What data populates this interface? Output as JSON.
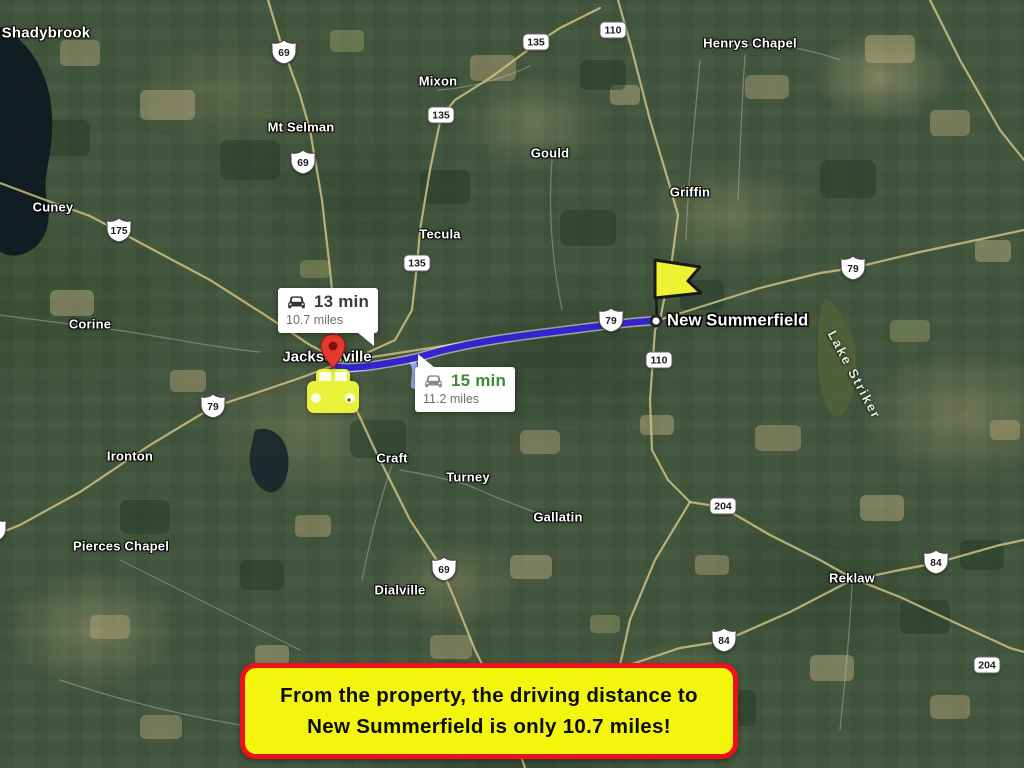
{
  "banner": {
    "line1": "From the property, the driving distance to",
    "line2": "New Summerfield is only 10.7 miles!"
  },
  "route": {
    "origin": "Jacksonville",
    "destination": "New Summerfield",
    "primary": {
      "duration": "13 min",
      "distance": "10.7 miles"
    },
    "alternate": {
      "duration": "15 min",
      "distance": "11.2 miles"
    }
  },
  "map": {
    "lake_label": "Lake Striker",
    "towns": [
      {
        "name": "Shadybrook",
        "x": 46,
        "y": 33,
        "size": "lg"
      },
      {
        "name": "Mixon",
        "x": 438,
        "y": 81
      },
      {
        "name": "Henrys Chapel",
        "x": 750,
        "y": 43
      },
      {
        "name": "Mt Selman",
        "x": 301,
        "y": 127
      },
      {
        "name": "Gould",
        "x": 550,
        "y": 153
      },
      {
        "name": "Griffin",
        "x": 690,
        "y": 192
      },
      {
        "name": "Cuney",
        "x": 53,
        "y": 207
      },
      {
        "name": "Tecula",
        "x": 440,
        "y": 234
      },
      {
        "name": "Corine",
        "x": 90,
        "y": 324
      },
      {
        "name": "Ironton",
        "x": 130,
        "y": 456
      },
      {
        "name": "Craft",
        "x": 392,
        "y": 458
      },
      {
        "name": "Turney",
        "x": 468,
        "y": 477
      },
      {
        "name": "Gallatin",
        "x": 558,
        "y": 517
      },
      {
        "name": "Pierces Chapel",
        "x": 121,
        "y": 546
      },
      {
        "name": "Dialville",
        "x": 400,
        "y": 590
      },
      {
        "name": "Reklaw",
        "x": 852,
        "y": 578
      }
    ],
    "us_shields": [
      {
        "num": "69",
        "x": 284,
        "y": 52
      },
      {
        "num": "69",
        "x": 303,
        "y": 162
      },
      {
        "num": "175",
        "x": 119,
        "y": 230
      },
      {
        "num": "79",
        "x": 213,
        "y": 406
      },
      {
        "num": "79",
        "x": 611,
        "y": 320,
        "under": true
      },
      {
        "num": "79",
        "x": 853,
        "y": 268
      },
      {
        "num": "79",
        "x": -6,
        "y": 530
      },
      {
        "num": "69",
        "x": 444,
        "y": 569
      },
      {
        "num": "84",
        "x": 936,
        "y": 562
      },
      {
        "num": "84",
        "x": 724,
        "y": 640
      }
    ],
    "state_shields": [
      {
        "num": "135",
        "x": 536,
        "y": 42
      },
      {
        "num": "110",
        "x": 613,
        "y": 30
      },
      {
        "num": "135",
        "x": 441,
        "y": 115
      },
      {
        "num": "135",
        "x": 417,
        "y": 263
      },
      {
        "num": "110",
        "x": 659,
        "y": 360
      },
      {
        "num": "204",
        "x": 723,
        "y": 506
      },
      {
        "num": "204",
        "x": 987,
        "y": 665
      }
    ]
  },
  "colors": {
    "route_primary": "#3523cf",
    "route_alternate": "#8ea8ea",
    "banner_bg": "#f4f50c",
    "banner_border": "#ee1118",
    "alt_duration_green": "#3d8b37",
    "flag_yellow": "#eef233",
    "car_yellow": "#e8f23a",
    "pin_red": "#e23b2e"
  }
}
